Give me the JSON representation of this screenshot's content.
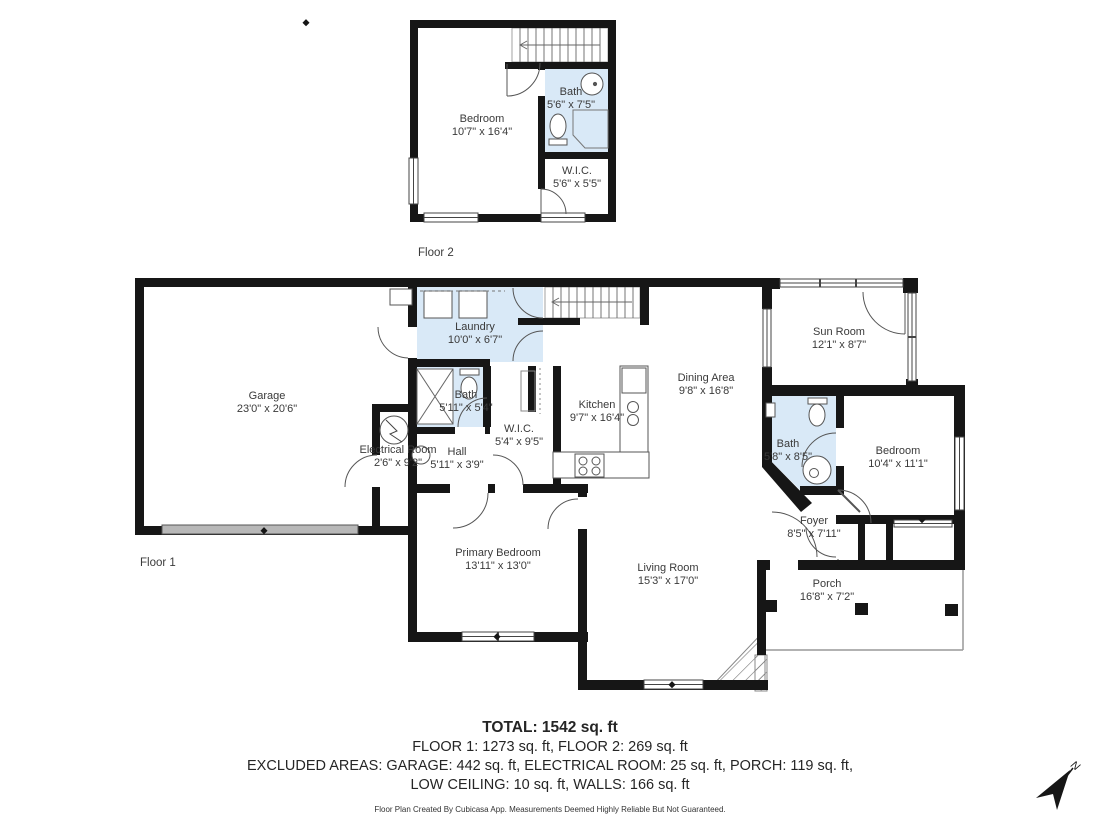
{
  "colors": {
    "wall": "#161616",
    "wet_room_fill": "#d9e9f7",
    "fixture_line": "#555555",
    "window_line": "#444444",
    "garage_door": "#b8b8b8",
    "porch_line": "#999999",
    "text": "#3a3a3a"
  },
  "floor2": {
    "caption": "Floor 2",
    "rooms": [
      {
        "name": "Bedroom",
        "dims": "10'7\" x 16'4\""
      },
      {
        "name": "Bath",
        "dims": "5'6\" x 7'5\""
      },
      {
        "name": "W.I.C.",
        "dims": "5'6\" x 5'5\""
      }
    ]
  },
  "floor1": {
    "caption": "Floor 1",
    "rooms": [
      {
        "name": "Garage",
        "dims": "23'0\" x 20'6\""
      },
      {
        "name": "Electrical Room",
        "dims": "2'6\" x 9'2\""
      },
      {
        "name": "Laundry",
        "dims": "10'0\" x 6'7\""
      },
      {
        "name": "Bath",
        "dims": "5'11\" x 5'4\""
      },
      {
        "name": "Hall",
        "dims": "5'11\" x 3'9\""
      },
      {
        "name": "W.I.C.",
        "dims": "5'4\" x 9'5\""
      },
      {
        "name": "Kitchen",
        "dims": "9'7\" x 16'4\""
      },
      {
        "name": "Dining Area",
        "dims": "9'8\" x 16'8\""
      },
      {
        "name": "Sun Room",
        "dims": "12'1\" x 8'7\""
      },
      {
        "name": "Bath",
        "dims": "5'8\" x 8'5\""
      },
      {
        "name": "Bedroom",
        "dims": "10'4\" x 11'1\""
      },
      {
        "name": "Foyer",
        "dims": "8'5\" x 7'11\""
      },
      {
        "name": "Primary Bedroom",
        "dims": "13'11\" x 13'0\""
      },
      {
        "name": "Living Room",
        "dims": "15'3\" x 17'0\""
      },
      {
        "name": "Porch",
        "dims": "16'8\" x 7'2\""
      }
    ]
  },
  "summary": {
    "total": "TOTAL: 1542 sq. ft",
    "floors_line": "FLOOR 1: 1273 sq. ft, FLOOR 2: 269 sq. ft",
    "excluded_line1": "EXCLUDED AREAS: GARAGE: 442 sq. ft, ELECTRICAL ROOM: 25 sq. ft, PORCH: 119 sq. ft,",
    "excluded_line2": "LOW CEILING: 10 sq. ft, WALLS: 166 sq. ft",
    "disclaimer": "Floor Plan Created By Cubicasa App. Measurements Deemed Highly Reliable But Not Guaranteed."
  },
  "compass": {
    "label": "N"
  }
}
